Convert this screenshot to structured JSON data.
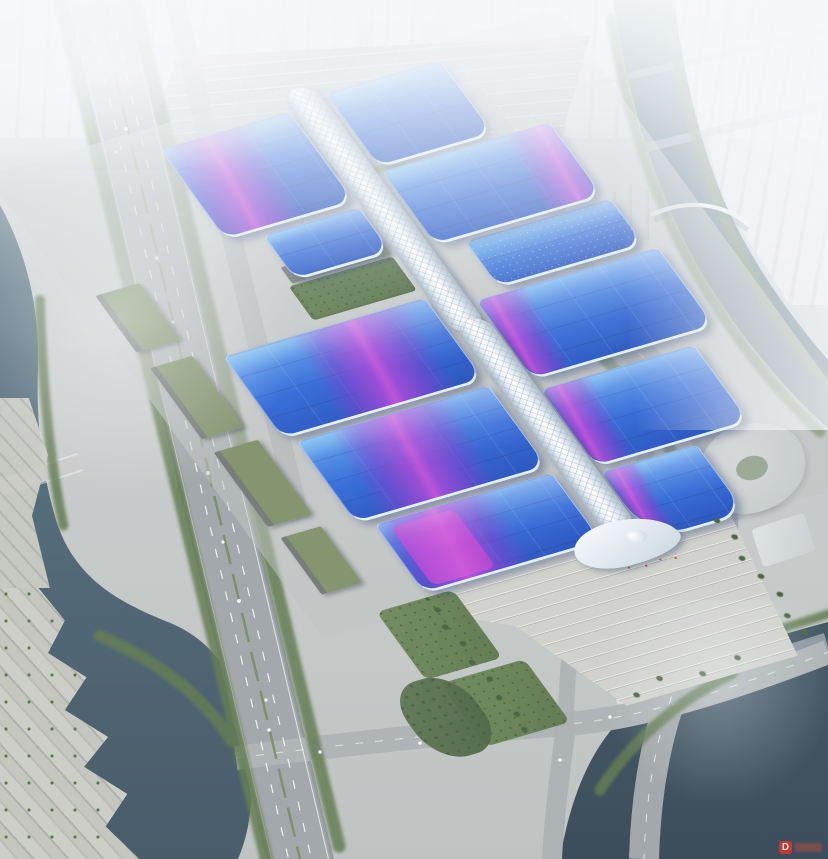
{
  "scene": {
    "type": "aerial architectural rendering",
    "subject": "riverside exhibition and convention center complex",
    "atmosphere": "hazy daylight, fog over distant city skyline",
    "complex": {
      "central_spine": "white lattice pedestrian corridor running north-south with flared entrance canopy at south end",
      "hall_rows_left": 4,
      "hall_rows_right": 5,
      "roof_motif": "blue vaulted roofs crossed by sweeping purple-magenta ribbons",
      "courtyards": "green garden strips between northern hall rows",
      "south_plaza": "stepped entrance plaza with palm trees and red crowd/flag specks"
    },
    "surroundings": [
      "elevated multi-lane highway along west side",
      "canal with terraced concrete banks at west and southwest",
      "large dark lake with road bridge at southeast",
      "curving tree-lined boulevard on east side",
      "river with arched pedestrian bridge at northeast",
      "rows of parked cars in north parking lot",
      "fog-shrouded city blocks and dome landmark to the north",
      "curved white courtyard building to the east"
    ]
  },
  "palette": {
    "hall_blue_deep": "#1f4cba",
    "hall_blue_mid": "#2b63d4",
    "hall_blue_light": "#62b4ee",
    "ribbon_purple": "#8f46d8",
    "ribbon_magenta": "#cd4ed8",
    "spine_white": "#eef3f7",
    "water_dark": "#42596a",
    "lake_dark": "#33434f",
    "tree_green": "#5c7549",
    "plaza_concrete": "#cfd0ca",
    "road_gray": "#9da3a5",
    "haze_white": "#f6f9fb",
    "crowd_red": "#d64033"
  },
  "watermark": {
    "logo_text": "D",
    "logo_color": "#d8372c"
  }
}
